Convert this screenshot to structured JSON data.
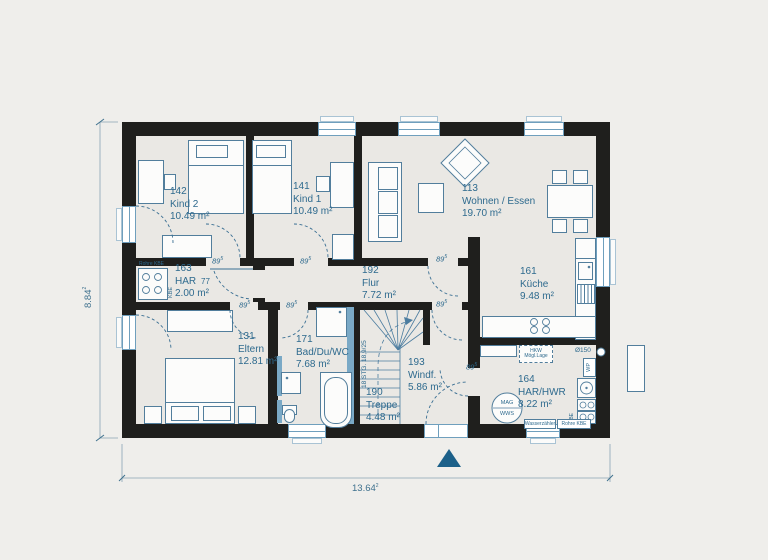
{
  "plan": {
    "rooms": [
      {
        "id": "142",
        "name": "Kind 2",
        "area": "10.49 m²"
      },
      {
        "id": "141",
        "name": "Kind 1",
        "area": "10.49 m²"
      },
      {
        "id": "113",
        "name": "Wohnen / Essen",
        "area": "19.70 m²"
      },
      {
        "id": "161",
        "name": "Küche",
        "area": "9.48 m²"
      },
      {
        "id": "163",
        "name": "HAR",
        "area": "2.00 m²"
      },
      {
        "id": "192",
        "name": "Flur",
        "area": "7.72 m²"
      },
      {
        "id": "131",
        "name": "Eltern",
        "area": "12.81 m²"
      },
      {
        "id": "171",
        "name": "Bad/Du/WC",
        "area": "7.68 m²"
      },
      {
        "id": "193",
        "name": "Windf.",
        "area": "5.86 m²"
      },
      {
        "id": "190",
        "name": "Treppe",
        "area": "4.48 m²"
      },
      {
        "id": "164",
        "name": "HAR/HWR",
        "area": "8.22 m²"
      }
    ],
    "dimensions": {
      "height": "8.84",
      "height_sup": "2",
      "width": "13.64",
      "width_sup": "2"
    },
    "annotations": {
      "door_width": "89",
      "door_width_sup": "5",
      "har_door_width": "77",
      "stairs": "18 STG. 18,9/25",
      "rohre_kbe": "Rohre KBE",
      "kbe": "KBE",
      "hkw_line1": "HKW",
      "hkw_line2": "Mögl.Lage",
      "duct": "Ø150",
      "wp": "WP",
      "mag": "MAG",
      "wws": "WWS",
      "water_meter": "Wasserzähler",
      "pipes": "Rohre KBE"
    },
    "colors": {
      "background": "#efeeeb",
      "floor": "#eae8e4",
      "wall": "#1f1f1d",
      "line_blue": "#4c7da0",
      "text_blue": "#2e6a8e",
      "tile_blue": "#7aa9c6",
      "accent_teal": "#1c6089"
    }
  }
}
